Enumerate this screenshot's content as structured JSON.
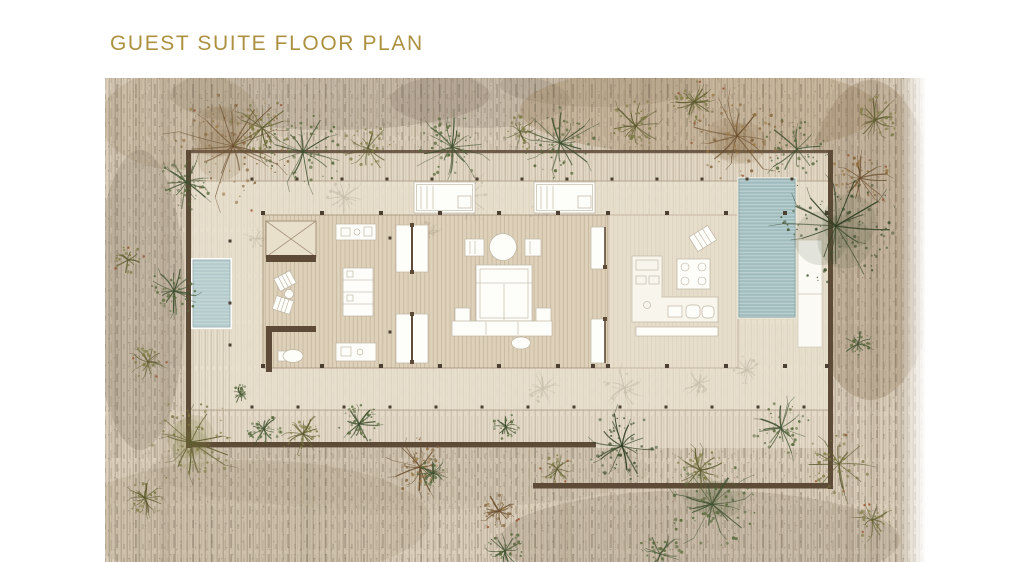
{
  "title": "GUEST SUITE FLOOR PLAN",
  "colors": {
    "background": "#ffffff",
    "title_gold": "#ac9140",
    "wall_brown": "#5d4a37",
    "scrub_base": "#dbcfbc",
    "courtyard": "#e8e0cf",
    "floor": "#ded1b9",
    "deck": "#e6ddcb",
    "pool_teal": "#a3bfc0",
    "plunge_pool_teal": "#b8cecf",
    "furniture_white": "#fdfdf9",
    "foliage_green": "#55683a",
    "foliage_olive": "#7d7a41",
    "foliage_dark": "#3f512e",
    "foliage_brown": "#86653c"
  },
  "plan": {
    "aria_label": "Rendered site plan of a guest suite pavilion with courtyard walls, pools and scrub landscape",
    "features": [
      "boundary-walls",
      "column-grid",
      "plunge-pool",
      "swimming-pool",
      "pool-deck-loungers",
      "deck-daybeds",
      "outdoor-shower-court",
      "wc",
      "patio-lounge-chairs",
      "vanity-counter",
      "wardrobe",
      "sliding-doors",
      "bed",
      "nightstands",
      "foot-bench",
      "kitchen-counter",
      "cooktop-island",
      "dining-set",
      "kitchen-lounge-chair",
      "trees-and-shrubs"
    ],
    "column_dot_rows": [
      {
        "y": 179,
        "size": 3,
        "x": [
          252,
          297,
          342,
          387,
          432,
          477,
          522,
          567,
          612,
          657,
          702,
          747,
          792
        ]
      },
      {
        "y": 213,
        "size": 4,
        "x": [
          263,
          322,
          381,
          440,
          499,
          558,
          608,
          667,
          726,
          785,
          827
        ]
      },
      {
        "y": 366,
        "size": 4,
        "x": [
          263,
          322,
          381,
          440,
          499,
          558,
          593,
          608,
          667,
          726,
          785,
          827
        ]
      },
      {
        "y": 407,
        "size": 3,
        "x": [
          252,
          298,
          344,
          390,
          436,
          482,
          528,
          574,
          620,
          666,
          712,
          758,
          804
        ]
      }
    ],
    "extra_dots": [
      [
        230,
        241
      ],
      [
        230,
        303
      ],
      [
        230,
        345
      ],
      [
        390,
        238
      ],
      [
        390,
        332
      ]
    ],
    "trees": [
      [
        233,
        146,
        56,
        "brown"
      ],
      [
        186,
        182,
        28,
        "green"
      ],
      [
        262,
        128,
        30,
        "olive"
      ],
      [
        303,
        152,
        38,
        "green"
      ],
      [
        368,
        148,
        24,
        "olive"
      ],
      [
        452,
        147,
        32,
        "green"
      ],
      [
        520,
        132,
        18,
        "olive"
      ],
      [
        560,
        143,
        34,
        "green"
      ],
      [
        636,
        126,
        26,
        "olive"
      ],
      [
        694,
        102,
        20,
        "olive"
      ],
      [
        737,
        136,
        46,
        "brown"
      ],
      [
        797,
        149,
        32,
        "green"
      ],
      [
        860,
        178,
        28,
        "brown"
      ],
      [
        836,
        226,
        60,
        "dark"
      ],
      [
        875,
        120,
        22,
        "olive"
      ],
      [
        174,
        291,
        24,
        "green"
      ],
      [
        148,
        362,
        16,
        "olive"
      ],
      [
        128,
        260,
        14,
        "olive"
      ],
      [
        191,
        442,
        44,
        "olive"
      ],
      [
        264,
        429,
        18,
        "green"
      ],
      [
        303,
        434,
        22,
        "olive"
      ],
      [
        359,
        424,
        20,
        "green"
      ],
      [
        420,
        467,
        28,
        "brown"
      ],
      [
        433,
        473,
        15,
        "green"
      ],
      [
        241,
        394,
        9,
        "green"
      ],
      [
        145,
        498,
        18,
        "olive"
      ],
      [
        506,
        427,
        13,
        "green"
      ],
      [
        499,
        511,
        18,
        "brown"
      ],
      [
        505,
        551,
        20,
        "green"
      ],
      [
        557,
        469,
        14,
        "olive"
      ],
      [
        622,
        446,
        34,
        "dark"
      ],
      [
        660,
        554,
        22,
        "green"
      ],
      [
        712,
        504,
        42,
        "green"
      ],
      [
        700,
        470,
        24,
        "olive"
      ],
      [
        781,
        428,
        28,
        "green"
      ],
      [
        839,
        464,
        32,
        "olive"
      ],
      [
        858,
        344,
        14,
        "green"
      ],
      [
        872,
        520,
        18,
        "olive"
      ]
    ],
    "ghost_shrubs": [
      [
        468,
        196,
        26
      ],
      [
        344,
        197,
        18
      ],
      [
        543,
        389,
        15
      ],
      [
        624,
        388,
        20
      ],
      [
        699,
        383,
        15
      ],
      [
        428,
        233,
        11
      ],
      [
        256,
        239,
        11
      ],
      [
        747,
        370,
        14
      ],
      [
        540,
        208,
        13
      ]
    ]
  }
}
